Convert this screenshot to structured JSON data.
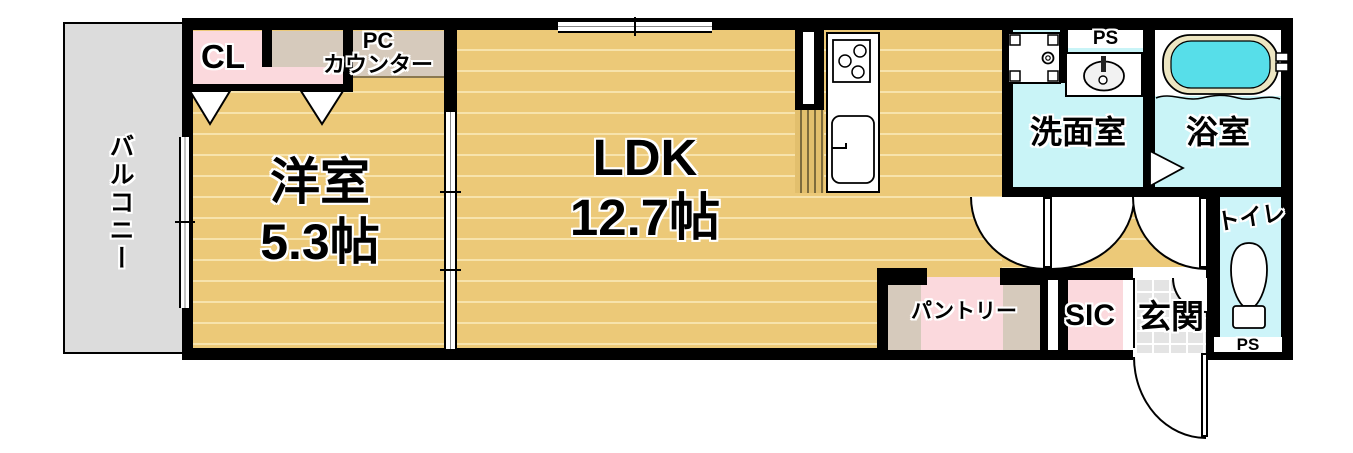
{
  "plan_title": "1LDK apartment floor plan",
  "rooms": {
    "balcony": {
      "label": "バルコニー"
    },
    "western": {
      "label": "洋室",
      "area": "5.3帖"
    },
    "ldk": {
      "label": "LDK",
      "area": "12.7帖"
    },
    "closet": {
      "label": "CL"
    },
    "pc_counter": {
      "line1": "PC",
      "line2": "カウンター"
    },
    "washroom": {
      "label": "洗面室"
    },
    "bathroom": {
      "label": "浴室"
    },
    "toilet": {
      "label": "トイレ"
    },
    "pantry": {
      "label": "パントリー"
    },
    "sic": {
      "label": "SIC"
    },
    "entrance": {
      "label": "玄関"
    },
    "pipe_space_top": {
      "label": "PS"
    },
    "pipe_space_bottom": {
      "label": "PS"
    }
  },
  "fixtures": [
    "gas-stove",
    "kitchen-sink",
    "washing-machine-pan",
    "wash-basin",
    "bathtub",
    "toilet-bowl",
    "door-swing-arc",
    "entrance-door-swing",
    "sliding-window",
    "sliding-partition",
    "folding-closet-door",
    "bath-door-triangle"
  ],
  "colors": {
    "wall": "#000000",
    "floor_tan": "#ecc978",
    "floor_stripe": "#f7e3ac",
    "closet_pink": "#fbd9dd",
    "counter_taupe": "#d6cabc",
    "wet_area_cyan": "#c9f4f7",
    "bath_water": "#57dee9",
    "tub_rim": "#ede6c2",
    "balcony_gray": "#dcdcdc",
    "entrance_tile": "#e4e4e4"
  }
}
